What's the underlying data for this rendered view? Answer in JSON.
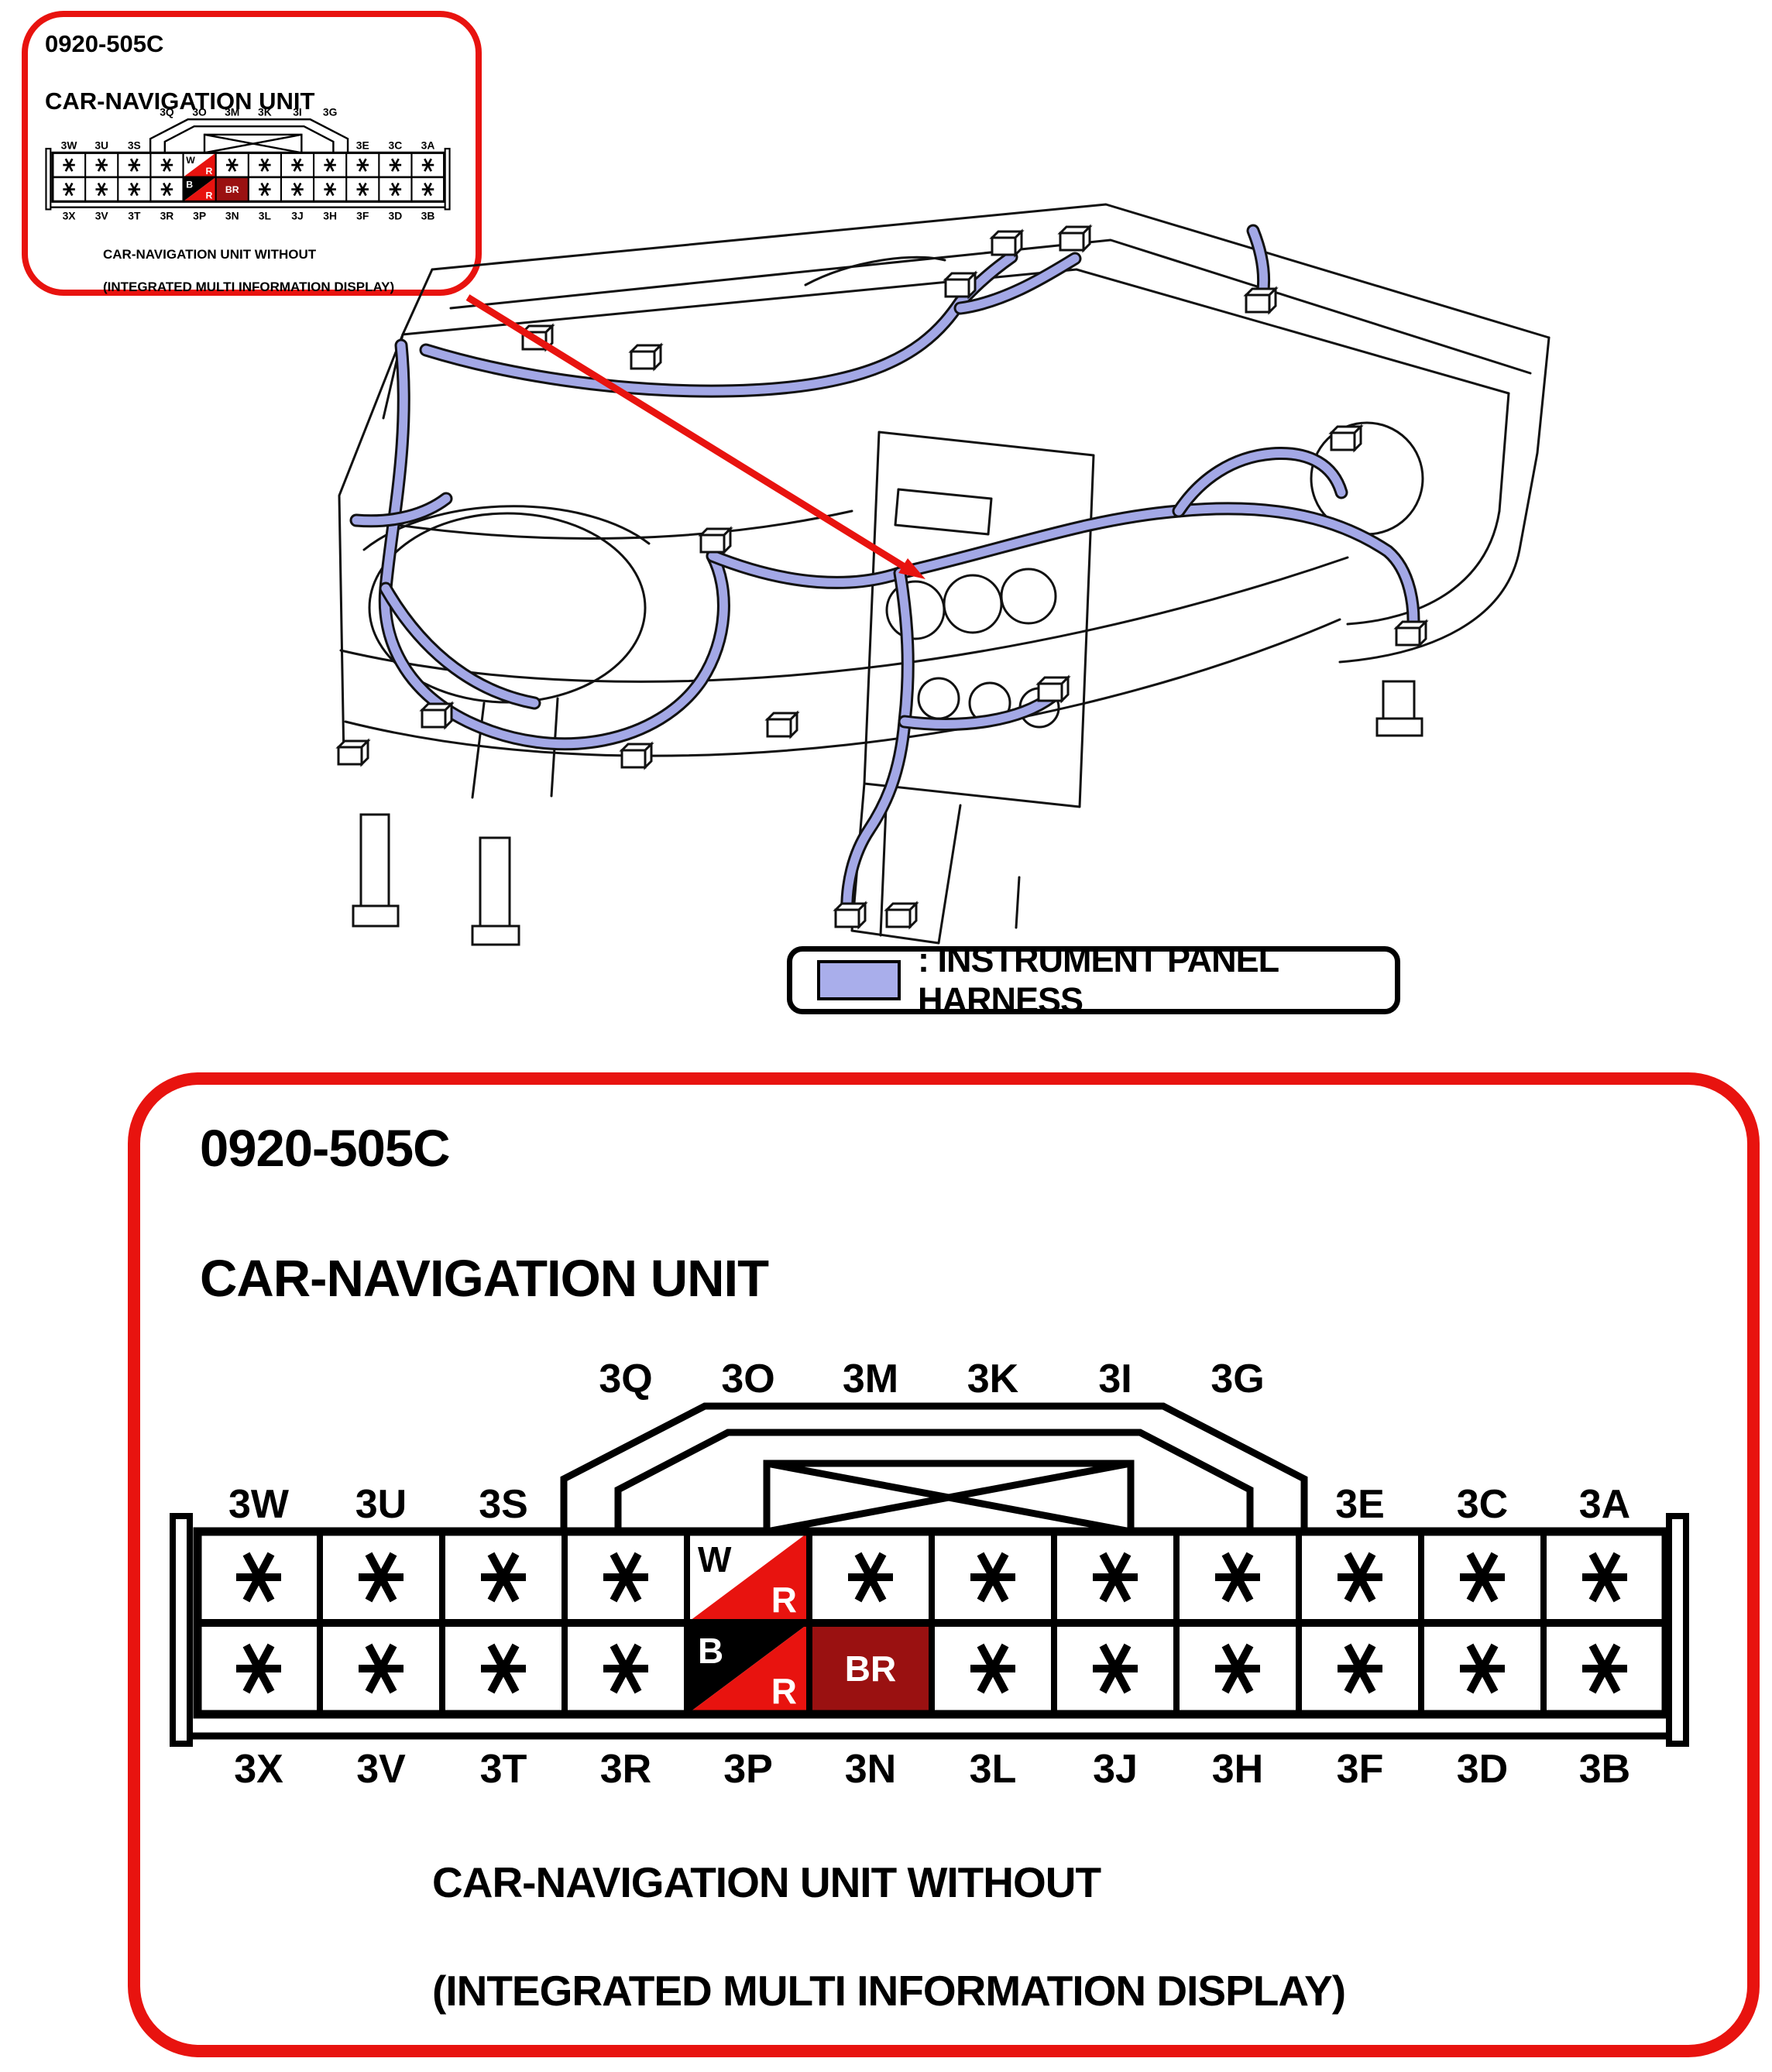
{
  "unit": {
    "code": "0920-505C",
    "name": "CAR-NAVIGATION UNIT",
    "caption_line1": "CAR-NAVIGATION UNIT WITHOUT",
    "caption_line2": "(INTEGRATED MULTI INFORMATION DISPLAY)"
  },
  "legend": {
    "label": ": INSTRUMENT PANEL HARNESS",
    "swatch_color": "#a9aeeb"
  },
  "connector": {
    "bump_labels": [
      "3Q",
      "3O",
      "3M",
      "3K",
      "3I",
      "3G"
    ],
    "upper_labels_left": [
      "3W",
      "3U",
      "3S"
    ],
    "upper_labels_right": [
      "3E",
      "3C",
      "3A"
    ],
    "bottom_labels": [
      "3X",
      "3V",
      "3T",
      "3R",
      "3P",
      "3N",
      "3L",
      "3J",
      "3H",
      "3F",
      "3D",
      "3B"
    ],
    "rows": [
      [
        "*",
        "*",
        "*",
        "*",
        "W/R",
        "*",
        "*",
        "*",
        "*",
        "*",
        "*",
        "*"
      ],
      [
        "*",
        "*",
        "*",
        "*",
        "B/R",
        "BR",
        "*",
        "*",
        "*",
        "*",
        "*",
        "*"
      ]
    ],
    "special_cells": {
      "W/R": {
        "top_left": "W",
        "bottom_right": "R",
        "style": "white-over-red"
      },
      "B/R": {
        "top_left": "B",
        "bottom_right": "R",
        "style": "black-over-red"
      },
      "BR": {
        "label": "BR",
        "style": "solid-dark-red"
      }
    },
    "colors": {
      "red": "#e8130f",
      "dark_red": "#9a1111",
      "harness": "#a3a8e6",
      "black": "#000000"
    }
  }
}
